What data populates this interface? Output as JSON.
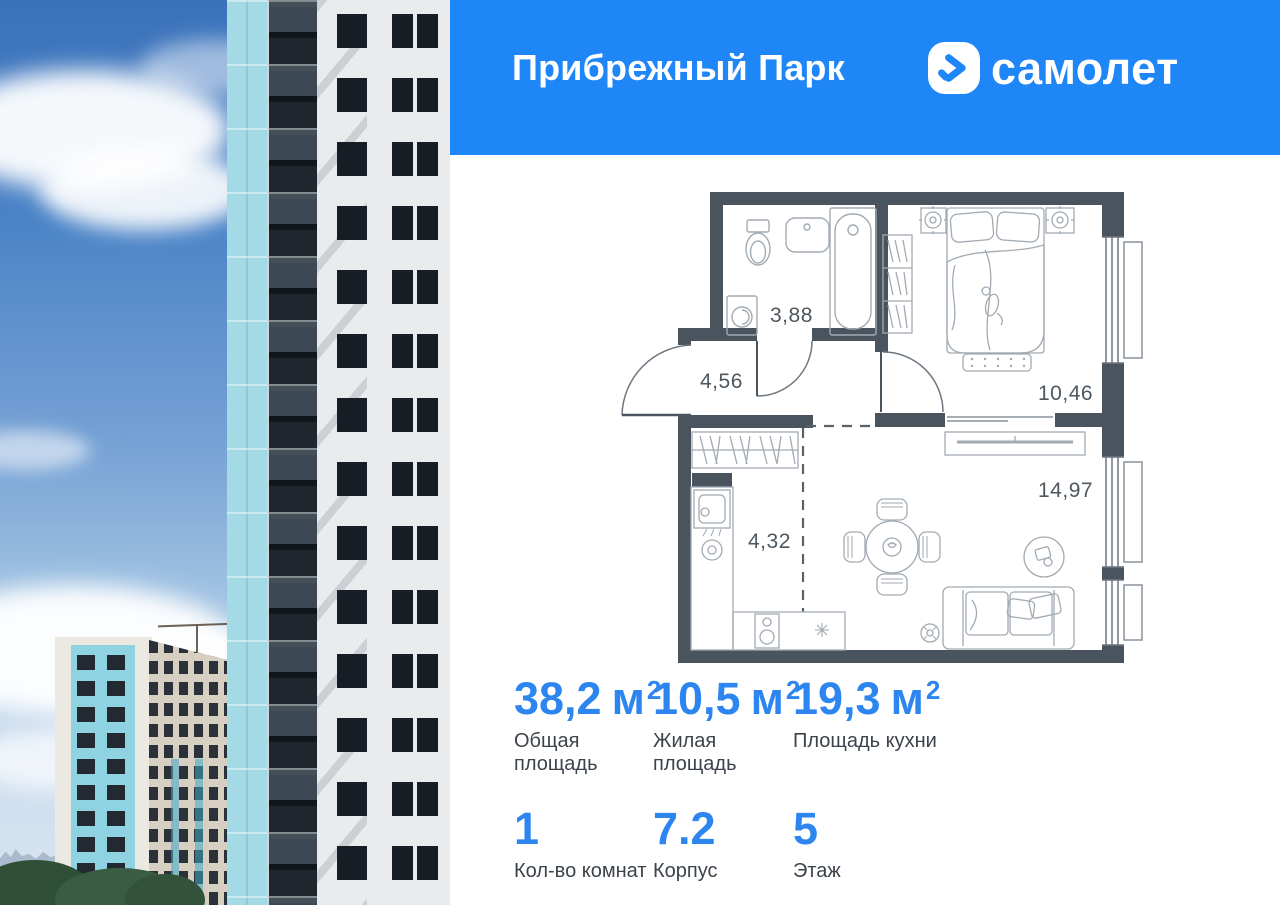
{
  "header": {
    "project_title": "Прибрежный Парк",
    "brand_wordmark": "самолет"
  },
  "floor_plan": {
    "room_areas": {
      "bathroom": "3,88",
      "hallway": "4,56",
      "bedroom": "10,46",
      "living_room": "14,97",
      "kitchen": "4,32"
    }
  },
  "stats": [
    {
      "value": "38,2",
      "unit": "м",
      "unit_sup": "2",
      "label": "Общая площадь"
    },
    {
      "value": "10,5",
      "unit": "м",
      "unit_sup": "2",
      "label": "Жилая площадь"
    },
    {
      "value": "19,3",
      "unit": "м",
      "unit_sup": "2",
      "label": "Площадь кухни"
    },
    {
      "value": "1",
      "unit": "",
      "unit_sup": "",
      "label": "Кол-во комнат"
    },
    {
      "value": "7.2",
      "unit": "",
      "unit_sup": "",
      "label": "Корпус"
    },
    {
      "value": "5",
      "unit": "",
      "unit_sup": "",
      "label": "Этаж"
    }
  ],
  "colors": {
    "header_blue": "#1e86f6",
    "stat_blue": "#2d86f0",
    "plan_wall": "#4a545e",
    "facade_teal": "#a3dae6"
  }
}
